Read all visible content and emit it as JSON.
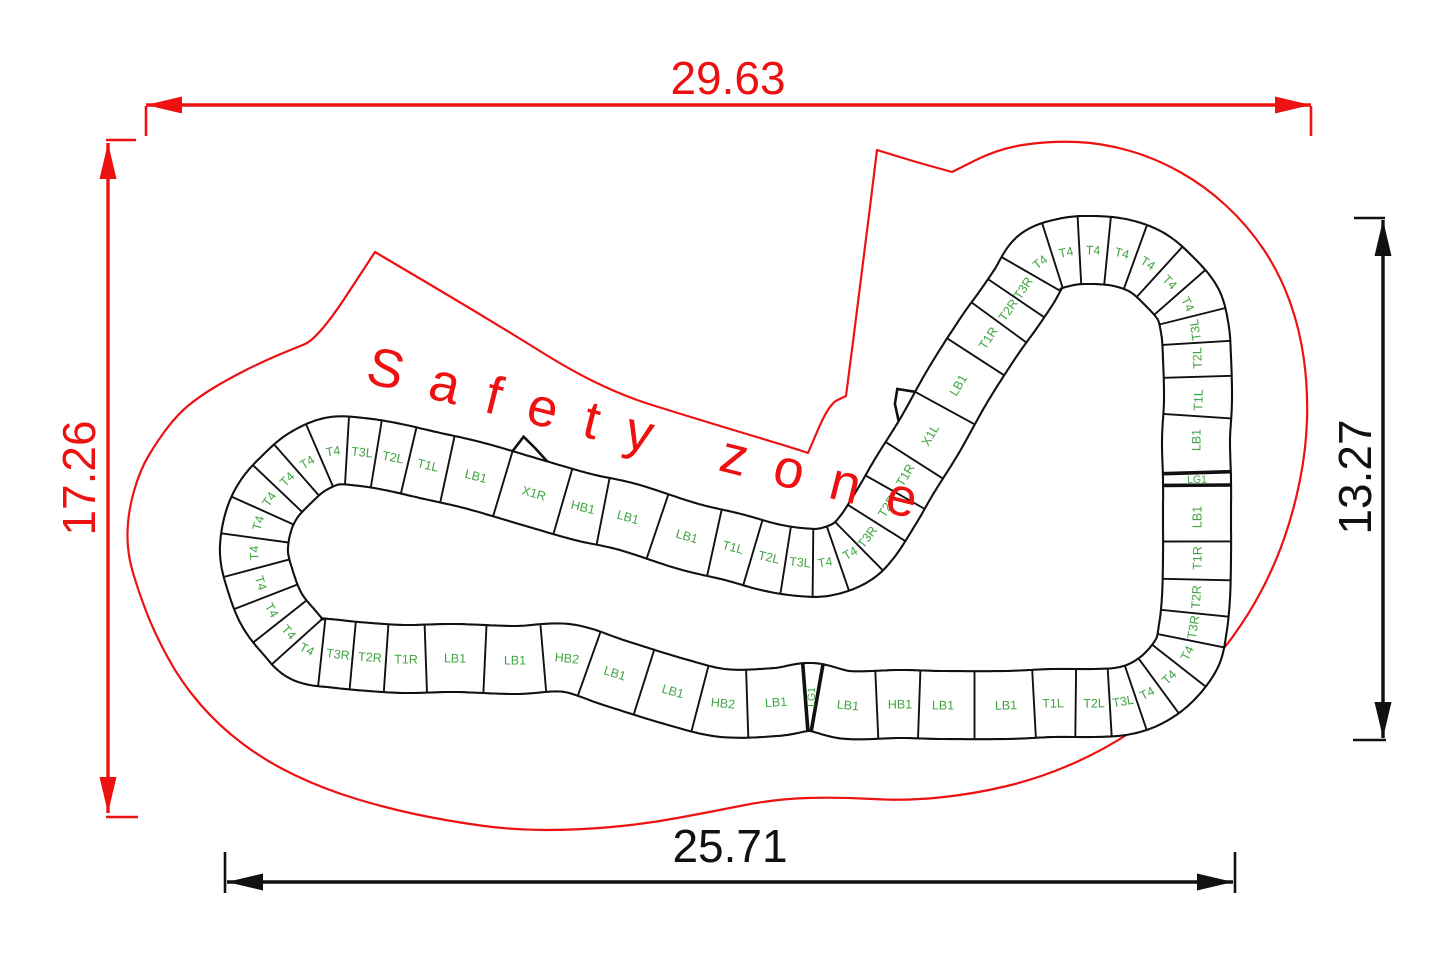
{
  "safety_zone_label": "Safety zone",
  "colors": {
    "red": "#ee1111",
    "green": "#41a441",
    "black": "#111111",
    "track_line": "#111111",
    "white": "#ffffff"
  },
  "dims": {
    "top": {
      "value": "29.63",
      "color": "red",
      "x1": 146,
      "y1": 105,
      "x2": 1311,
      "y2": 105,
      "ext": [
        [
          146,
          106,
          146,
          136
        ],
        [
          1311,
          106,
          1311,
          136
        ]
      ]
    },
    "left": {
      "value": "17.26",
      "color": "red",
      "x1": 108,
      "y1": 143,
      "x2": 108,
      "y2": 813,
      "ext": [
        [
          106,
          140,
          136,
          140
        ],
        [
          106,
          817,
          138,
          817
        ]
      ]
    },
    "right": {
      "value": "13.27",
      "color": "black",
      "x1": 1383,
      "y1": 220,
      "x2": 1383,
      "y2": 738,
      "ext": [
        [
          1354,
          218,
          1385,
          218
        ],
        [
          1353,
          740,
          1386,
          740
        ]
      ]
    },
    "bottom": {
      "value": "25.71",
      "color": "black",
      "x1": 227,
      "y1": 882,
      "x2": 1233,
      "y2": 882,
      "ext": [
        [
          225,
          852,
          225,
          893
        ],
        [
          1235,
          852,
          1235,
          893
        ]
      ]
    }
  },
  "track": {
    "half_width": 34,
    "segments": [
      {
        "label": "T3L",
        "x": 362,
        "y": 452,
        "w": 29
      },
      {
        "label": "T2L",
        "x": 393,
        "y": 457,
        "w": 34
      },
      {
        "label": "T1L",
        "x": 428,
        "y": 465,
        "w": 42
      },
      {
        "label": "LB1",
        "x": 476,
        "y": 476,
        "w": 62
      },
      {
        "label": "X1R",
        "x": 534,
        "y": 493,
        "w": 72,
        "bump": "start"
      },
      {
        "label": "HB1",
        "x": 583,
        "y": 507,
        "w": 50
      },
      {
        "label": "LB1",
        "x": 628,
        "y": 517,
        "w": 62
      },
      {
        "label": "LB1",
        "x": 687,
        "y": 536,
        "w": 62
      },
      {
        "label": "T1L",
        "x": 733,
        "y": 547,
        "w": 42
      },
      {
        "label": "T2L",
        "x": 769,
        "y": 557,
        "w": 34
      },
      {
        "label": "T3L",
        "x": 800,
        "y": 562,
        "w": 29
      },
      {
        "label": "T4",
        "x": 825,
        "y": 562,
        "w": 27
      },
      {
        "label": "T4",
        "x": 850,
        "y": 553,
        "w": 27
      },
      {
        "label": "T3R",
        "x": 867,
        "y": 537,
        "w": 29
      },
      {
        "label": "T2R",
        "x": 887,
        "y": 506,
        "w": 34
      },
      {
        "label": "T1R",
        "x": 905,
        "y": 475,
        "w": 42
      },
      {
        "label": "X1L",
        "x": 930,
        "y": 435,
        "w": 72,
        "bump": "end"
      },
      {
        "label": "LB1",
        "x": 958,
        "y": 385,
        "w": 62
      },
      {
        "label": "T1R",
        "x": 988,
        "y": 338,
        "w": 42
      },
      {
        "label": "T2R",
        "x": 1008,
        "y": 310,
        "w": 34
      },
      {
        "label": "T3R",
        "x": 1023,
        "y": 288,
        "w": 29
      },
      {
        "label": "T4",
        "x": 1040,
        "y": 262,
        "w": 27
      },
      {
        "label": "T4",
        "x": 1066,
        "y": 252,
        "w": 27
      },
      {
        "label": "T4",
        "x": 1093,
        "y": 250,
        "w": 27
      },
      {
        "label": "T4",
        "x": 1122,
        "y": 253,
        "w": 27
      },
      {
        "label": "T4",
        "x": 1148,
        "y": 263,
        "w": 27
      },
      {
        "label": "T4",
        "x": 1170,
        "y": 282,
        "w": 27
      },
      {
        "label": "T4",
        "x": 1188,
        "y": 304,
        "w": 27
      },
      {
        "label": "T3L",
        "x": 1195,
        "y": 330,
        "w": 29
      },
      {
        "label": "T2L",
        "x": 1197,
        "y": 358,
        "w": 34
      },
      {
        "label": "T1L",
        "x": 1198,
        "y": 400,
        "w": 42
      },
      {
        "label": "LB1",
        "x": 1196,
        "y": 440,
        "w": 62
      },
      {
        "label": "LG1",
        "x": 1197,
        "y": 479,
        "w": 12,
        "narrow": true
      },
      {
        "label": "LB1",
        "x": 1197,
        "y": 517,
        "w": 62
      },
      {
        "label": "T1R",
        "x": 1197,
        "y": 558,
        "w": 42
      },
      {
        "label": "T2R",
        "x": 1196,
        "y": 597,
        "w": 34
      },
      {
        "label": "T3R",
        "x": 1193,
        "y": 627,
        "w": 29
      },
      {
        "label": "T4",
        "x": 1187,
        "y": 653,
        "w": 27
      },
      {
        "label": "T4",
        "x": 1169,
        "y": 677,
        "w": 27
      },
      {
        "label": "T4",
        "x": 1147,
        "y": 693,
        "w": 27
      },
      {
        "label": "T3L",
        "x": 1123,
        "y": 701,
        "w": 29
      },
      {
        "label": "T2L",
        "x": 1094,
        "y": 703,
        "w": 34
      },
      {
        "label": "T1L",
        "x": 1053,
        "y": 703,
        "w": 42
      },
      {
        "label": "LB1",
        "x": 1006,
        "y": 705,
        "w": 62
      },
      {
        "label": "LB1",
        "x": 943,
        "y": 705,
        "w": 62
      },
      {
        "label": "HB1",
        "x": 900,
        "y": 704,
        "w": 50
      },
      {
        "label": "LB1",
        "x": 848,
        "y": 705,
        "w": 62
      },
      {
        "label": "LG1",
        "x": 811,
        "y": 697,
        "w": 12,
        "narrow": true
      },
      {
        "label": "LB1",
        "x": 776,
        "y": 702,
        "w": 62
      },
      {
        "label": "HB2",
        "x": 723,
        "y": 703,
        "w": 52
      },
      {
        "label": "LB1",
        "x": 673,
        "y": 691,
        "w": 62
      },
      {
        "label": "LB1",
        "x": 615,
        "y": 673,
        "w": 62
      },
      {
        "label": "HB2",
        "x": 567,
        "y": 658,
        "w": 52
      },
      {
        "label": "LB1",
        "x": 515,
        "y": 660,
        "w": 62
      },
      {
        "label": "LB1",
        "x": 455,
        "y": 658,
        "w": 62
      },
      {
        "label": "T1R",
        "x": 406,
        "y": 659,
        "w": 42
      },
      {
        "label": "T2R",
        "x": 370,
        "y": 657,
        "w": 34
      },
      {
        "label": "T3R",
        "x": 338,
        "y": 654,
        "w": 29
      },
      {
        "label": "T4",
        "x": 307,
        "y": 649,
        "w": 27
      },
      {
        "label": "T4",
        "x": 289,
        "y": 632,
        "w": 27
      },
      {
        "label": "T4",
        "x": 272,
        "y": 610,
        "w": 27
      },
      {
        "label": "T4",
        "x": 261,
        "y": 583,
        "w": 27
      },
      {
        "label": "T4",
        "x": 254,
        "y": 553,
        "w": 27
      },
      {
        "label": "T4",
        "x": 258,
        "y": 523,
        "w": 27
      },
      {
        "label": "T4",
        "x": 269,
        "y": 499,
        "w": 27
      },
      {
        "label": "T4",
        "x": 287,
        "y": 479,
        "w": 27
      },
      {
        "label": "T4",
        "x": 307,
        "y": 462,
        "w": 27
      },
      {
        "label": "T4",
        "x": 333,
        "y": 451,
        "w": 27
      }
    ]
  },
  "safety_outline": [
    [
      375,
      252
    ],
    [
      375,
      252
    ],
    [
      490,
      320
    ],
    [
      601,
      389
    ],
    [
      700,
      420
    ],
    [
      790,
      447
    ],
    [
      808,
      453
    ],
    [
      808,
      453
    ],
    [
      829,
      404
    ],
    [
      846,
      396
    ],
    [
      846,
      396
    ],
    [
      862,
      272
    ],
    [
      877,
      150
    ],
    [
      877,
      150
    ],
    [
      916,
      162
    ],
    [
      952,
      172
    ],
    [
      952,
      172
    ],
    [
      1000,
      148
    ],
    [
      1052,
      141
    ],
    [
      1102,
      143
    ],
    [
      1155,
      158
    ],
    [
      1205,
      186
    ],
    [
      1248,
      226
    ],
    [
      1280,
      274
    ],
    [
      1300,
      330
    ],
    [
      1308,
      390
    ],
    [
      1306,
      450
    ],
    [
      1294,
      510
    ],
    [
      1275,
      565
    ],
    [
      1247,
      618
    ],
    [
      1209,
      668
    ],
    [
      1161,
      712
    ],
    [
      1104,
      750
    ],
    [
      1040,
      778
    ],
    [
      974,
      794
    ],
    [
      905,
      801
    ],
    [
      840,
      797
    ],
    [
      775,
      799
    ],
    [
      710,
      812
    ],
    [
      645,
      824
    ],
    [
      578,
      830
    ],
    [
      513,
      830
    ],
    [
      448,
      821
    ],
    [
      386,
      808
    ],
    [
      324,
      789
    ],
    [
      267,
      762
    ],
    [
      219,
      726
    ],
    [
      181,
      682
    ],
    [
      154,
      632
    ],
    [
      138,
      590
    ],
    [
      127,
      552
    ],
    [
      128,
      512
    ],
    [
      140,
      470
    ],
    [
      158,
      440
    ],
    [
      178,
      414
    ],
    [
      200,
      396
    ],
    [
      230,
      378
    ],
    [
      262,
      362
    ],
    [
      290,
      350
    ],
    [
      318,
      339
    ]
  ]
}
